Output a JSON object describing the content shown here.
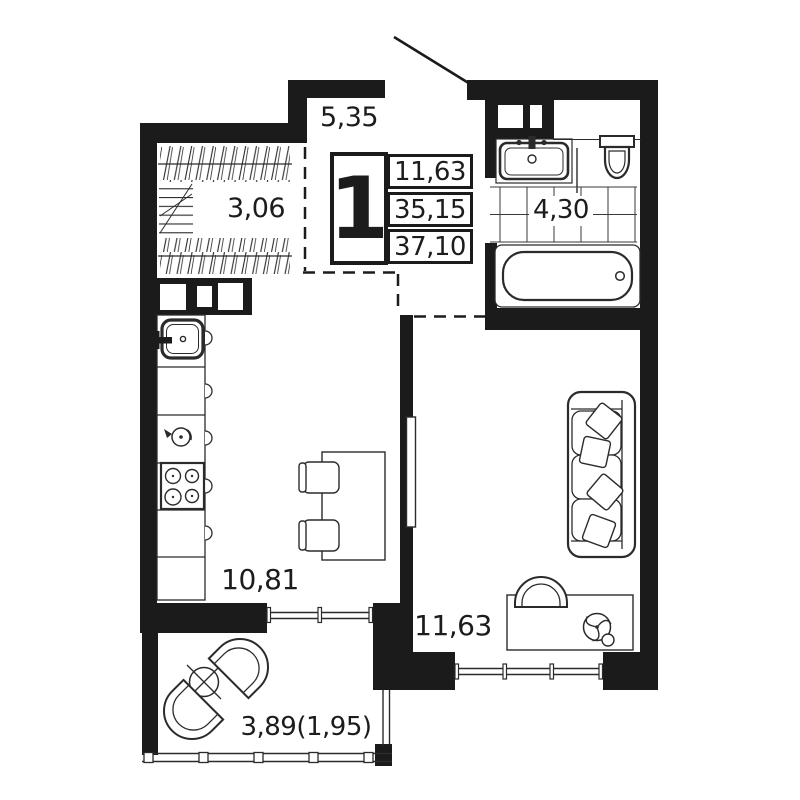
{
  "legend": {
    "rooms_count": "1",
    "values": [
      "11,63",
      "35,15",
      "37,10"
    ]
  },
  "rooms": {
    "hallway": "5,35",
    "wardrobe": "3,06",
    "bathroom": "4,30",
    "kitchen": "10,81",
    "living_room": "11,63",
    "balcony": "3,89(1,95)"
  },
  "colors": {
    "wall": "#1b1b1b",
    "line": "#2b2b2b",
    "bg": "#ffffff"
  }
}
